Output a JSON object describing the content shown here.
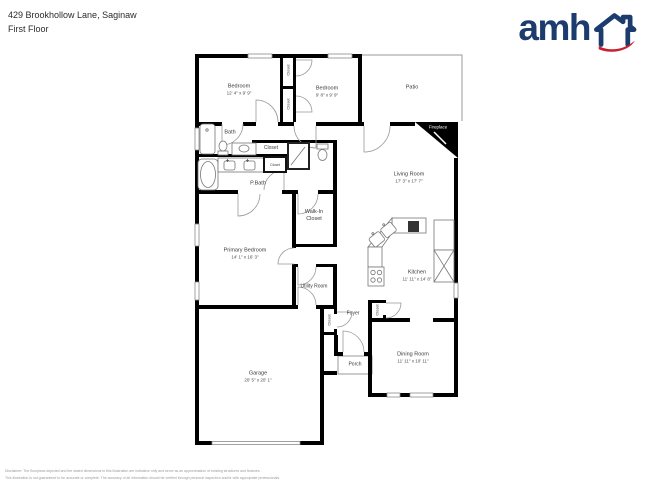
{
  "header": {
    "address": "429 Brookhollow Lane, Saginaw",
    "floor": "First Floor"
  },
  "logo": {
    "brand": "amh"
  },
  "colors": {
    "navy": "#1d3c6e",
    "red": "#c8202f",
    "wall": "#000000"
  },
  "labels": {
    "bedroom1": {
      "name": "Bedroom",
      "dims": "12' 4\" x 9' 9\""
    },
    "bedroom2": {
      "name": "Bedroom",
      "dims": "9' 8\" x 9' 9\""
    },
    "patio": {
      "name": "Patio"
    },
    "bath": {
      "name": "Bath"
    },
    "pbath": {
      "name": "P.Bath"
    },
    "living": {
      "name": "Living Room",
      "dims": "17' 3\" x 17' 7\""
    },
    "kitchen": {
      "name": "Kitchen",
      "dims": "11' 11\" x 14' 8\""
    },
    "primary": {
      "name": "Primary Bedroom",
      "dims": "14' 1\" x 16' 3\""
    },
    "walkin": {
      "line1": "Walk-In",
      "line2": "Closet"
    },
    "utility": {
      "name": "Utility Room"
    },
    "foyer": {
      "name": "Foyer"
    },
    "dining": {
      "name": "Dining Room",
      "dims": "11' 11\" x 10' 11\""
    },
    "garage": {
      "name": "Garage",
      "dims": "20' 5\" x 20' 1\""
    },
    "porch": {
      "name": "Porch"
    },
    "fireplace": {
      "name": "Fireplace"
    },
    "closet_top": {
      "name": "Closet"
    },
    "closet_mid": {
      "name": "Closet"
    },
    "closet_hall": {
      "name": "Closet"
    },
    "closet_small": {
      "name": "Closet"
    },
    "closet_foyer": {
      "name": "Closet"
    },
    "closet_kitchen": {
      "name": "Closet"
    }
  },
  "footer": {
    "line1": "Disclaimer: The floorplans depicted and the stated dimensions in this illustration are indicative only and serve as an approximation of existing structures and features.",
    "line2": "This illustration is not guaranteed to be accurate or complete. The accuracy of all information should be verified through personal inspection and/or with appropriate professionals."
  }
}
